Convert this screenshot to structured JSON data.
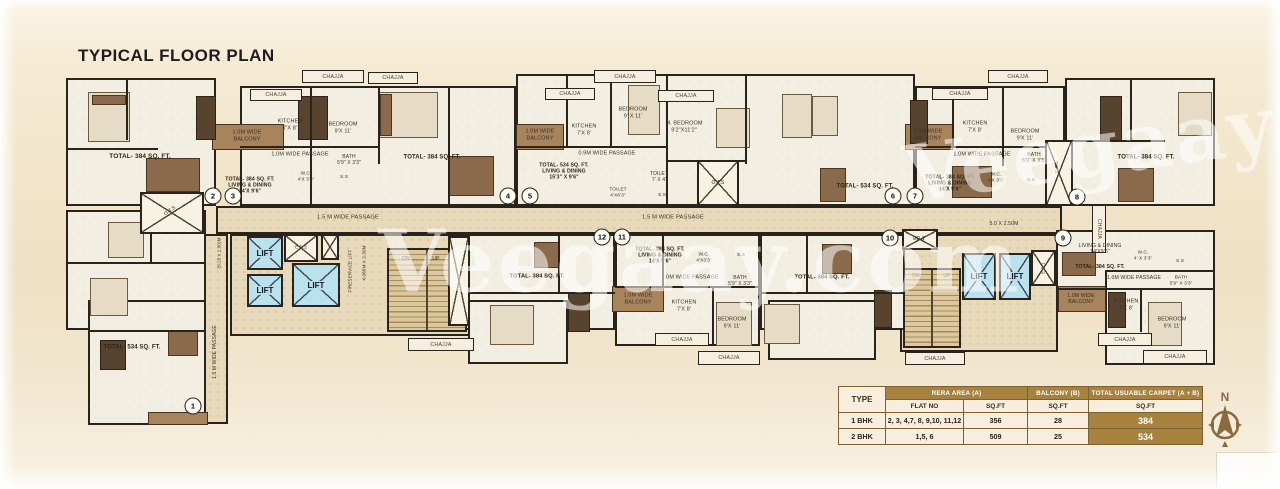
{
  "title": "TYPICAL FLOOR PLAN",
  "watermark": "Veegaay.com",
  "compass_label": "N",
  "colors": {
    "lift_blue": "#b9e1ee",
    "balcony_brown": "#a8845c",
    "wall": "#29231b",
    "table_brown": "#a7813e"
  },
  "table": {
    "col_type": "TYPE",
    "col_rera": "RERA AREA (A)",
    "col_balcony": "BALCONY (B)",
    "col_total": "TOTAL USUABLE CARPET (A + B)",
    "sub_flat_no": "FLAT NO",
    "sub_sqft": "SQ.FT",
    "rows": [
      {
        "type": "1 BHK",
        "flat_no": "2, 3, 4,7, 8, 9,10, 11,12",
        "rera_sqft": "356",
        "balcony_sqft": "28",
        "total_sqft": "384"
      },
      {
        "type": "2 BHK",
        "flat_no": "1,5, 6",
        "rera_sqft": "509",
        "balcony_sqft": "25",
        "total_sqft": "534"
      }
    ]
  },
  "plan": {
    "floors": [
      {
        "x": 66,
        "y": 78,
        "w": 150,
        "h": 128
      },
      {
        "x": 240,
        "y": 86,
        "w": 276,
        "h": 120
      },
      {
        "x": 516,
        "y": 74,
        "w": 399,
        "h": 132
      },
      {
        "x": 915,
        "y": 86,
        "w": 150,
        "h": 120
      },
      {
        "x": 1065,
        "y": 78,
        "w": 150,
        "h": 128
      },
      {
        "x": 455,
        "y": 234,
        "w": 160,
        "h": 96
      },
      {
        "x": 468,
        "y": 300,
        "w": 100,
        "h": 64
      },
      {
        "x": 615,
        "y": 234,
        "w": 145,
        "h": 112
      },
      {
        "x": 760,
        "y": 234,
        "w": 145,
        "h": 96
      },
      {
        "x": 768,
        "y": 300,
        "w": 108,
        "h": 60
      },
      {
        "x": 1056,
        "y": 230,
        "w": 159,
        "h": 82
      },
      {
        "x": 1105,
        "y": 270,
        "w": 110,
        "h": 95
      },
      {
        "x": 66,
        "y": 210,
        "w": 140,
        "h": 120
      },
      {
        "x": 88,
        "y": 300,
        "w": 118,
        "h": 125
      }
    ],
    "corridors": [
      {
        "x": 216,
        "y": 206,
        "w": 846,
        "h": 28
      },
      {
        "x": 204,
        "y": 234,
        "w": 24,
        "h": 190
      },
      {
        "x": 230,
        "y": 234,
        "w": 240,
        "h": 102
      },
      {
        "x": 900,
        "y": 234,
        "w": 158,
        "h": 118
      }
    ],
    "bands": [
      {
        "x": 212,
        "y": 124,
        "w": 72,
        "h": 26
      },
      {
        "x": 516,
        "y": 124,
        "w": 48,
        "h": 26
      },
      {
        "x": 905,
        "y": 124,
        "w": 48,
        "h": 26
      },
      {
        "x": 612,
        "y": 286,
        "w": 52,
        "h": 26
      },
      {
        "x": 1058,
        "y": 286,
        "w": 48,
        "h": 26
      },
      {
        "x": 148,
        "y": 412,
        "w": 60,
        "h": 13
      }
    ],
    "lifts": [
      {
        "x": 247,
        "y": 236,
        "w": 36,
        "h": 34,
        "label": "LIFT"
      },
      {
        "x": 247,
        "y": 274,
        "w": 36,
        "h": 33,
        "label": "LIFT"
      },
      {
        "x": 292,
        "y": 263,
        "w": 48,
        "h": 44,
        "label": "LIFT"
      },
      {
        "x": 962,
        "y": 253,
        "w": 34,
        "h": 47,
        "label": "LIFT"
      },
      {
        "x": 999,
        "y": 253,
        "w": 32,
        "h": 47,
        "label": "LIFT"
      }
    ],
    "ducts": [
      {
        "x": 284,
        "y": 234,
        "w": 34,
        "h": 28
      },
      {
        "x": 321,
        "y": 234,
        "w": 18,
        "h": 26
      },
      {
        "x": 448,
        "y": 236,
        "w": 22,
        "h": 90
      },
      {
        "x": 697,
        "y": 160,
        "w": 42,
        "h": 46
      },
      {
        "x": 1045,
        "y": 140,
        "w": 28,
        "h": 66
      },
      {
        "x": 902,
        "y": 229,
        "w": 36,
        "h": 21
      },
      {
        "x": 1031,
        "y": 250,
        "w": 25,
        "h": 36
      },
      {
        "x": 140,
        "y": 192,
        "w": 64,
        "h": 42
      }
    ],
    "stairs": [
      {
        "x": 387,
        "y": 248,
        "w": 80,
        "h": 84
      },
      {
        "x": 903,
        "y": 268,
        "w": 58,
        "h": 80
      }
    ],
    "chajjas": [
      {
        "x": 302,
        "y": 70,
        "w": 62,
        "h": 13,
        "label": "CHAJJA"
      },
      {
        "x": 250,
        "y": 89,
        "w": 52,
        "h": 12,
        "label": "CHAJJA"
      },
      {
        "x": 368,
        "y": 72,
        "w": 50,
        "h": 12,
        "label": "CHAJJA"
      },
      {
        "x": 545,
        "y": 88,
        "w": 50,
        "h": 12,
        "label": "CHAJJA"
      },
      {
        "x": 594,
        "y": 70,
        "w": 62,
        "h": 13,
        "label": "CHAJJA"
      },
      {
        "x": 658,
        "y": 90,
        "w": 56,
        "h": 12,
        "label": "CHAJJA"
      },
      {
        "x": 932,
        "y": 88,
        "w": 56,
        "h": 12,
        "label": "CHAJJA"
      },
      {
        "x": 988,
        "y": 70,
        "w": 60,
        "h": 13,
        "label": "CHAJJA"
      },
      {
        "x": 655,
        "y": 333,
        "w": 54,
        "h": 13,
        "label": "CHAJJA"
      },
      {
        "x": 698,
        "y": 351,
        "w": 62,
        "h": 14,
        "label": "CHAJJA"
      },
      {
        "x": 1098,
        "y": 333,
        "w": 54,
        "h": 13,
        "label": "CHAJJA"
      },
      {
        "x": 1143,
        "y": 350,
        "w": 64,
        "h": 14,
        "label": "CHAJJA"
      },
      {
        "x": 408,
        "y": 338,
        "w": 66,
        "h": 13,
        "label": "CHAJJA"
      },
      {
        "x": 905,
        "y": 352,
        "w": 60,
        "h": 13,
        "label": "CHAJJA"
      },
      {
        "x": 1092,
        "y": 205,
        "w": 14,
        "h": 48,
        "label": "CHAJJA",
        "v": 1
      }
    ],
    "flats": [
      {
        "n": "1",
        "x": 193,
        "y": 406
      },
      {
        "n": "2",
        "x": 213,
        "y": 196
      },
      {
        "n": "3",
        "x": 233,
        "y": 196
      },
      {
        "n": "4",
        "x": 508,
        "y": 196
      },
      {
        "n": "5",
        "x": 530,
        "y": 196
      },
      {
        "n": "6",
        "x": 893,
        "y": 196
      },
      {
        "n": "7",
        "x": 915,
        "y": 196
      },
      {
        "n": "8",
        "x": 1077,
        "y": 197
      },
      {
        "n": "9",
        "x": 1063,
        "y": 238
      },
      {
        "n": "10",
        "x": 890,
        "y": 238
      },
      {
        "n": "11",
        "x": 622,
        "y": 237
      },
      {
        "n": "12",
        "x": 602,
        "y": 237
      }
    ],
    "labels": [
      {
        "t": "TOTAL- 384 SQ. FT.",
        "x": 140,
        "y": 157,
        "s": 6.5,
        "b": 1
      },
      {
        "t": "1.0M WIDE\nBALCONY",
        "x": 247,
        "y": 136,
        "s": 5.5
      },
      {
        "t": "KITCHEN\n7'X 8'",
        "x": 290,
        "y": 125,
        "s": 5.5
      },
      {
        "t": "BEDROOM\n9'X 11'",
        "x": 343,
        "y": 128,
        "s": 5.5
      },
      {
        "t": "1.0M WIDE PASSAGE",
        "x": 300,
        "y": 155,
        "s": 5.5
      },
      {
        "t": "BATH\n5'9\" X 3'3\"",
        "x": 349,
        "y": 160,
        "s": 5
      },
      {
        "t": "W.C.\n4'X 3'3\"",
        "x": 306,
        "y": 177,
        "s": 4.8
      },
      {
        "t": "S.S",
        "x": 344,
        "y": 178,
        "s": 4.8
      },
      {
        "t": "TOTAL- 384 SQ. FT.\nLIVING & DINING\n14'X 9'6\"",
        "x": 250,
        "y": 186,
        "s": 5.2,
        "b": 1
      },
      {
        "t": "TOTAL- 384 SQ. FT.",
        "x": 432,
        "y": 158,
        "s": 6,
        "b": 1
      },
      {
        "t": "1.0M WIDE\nBALCONY",
        "x": 540,
        "y": 135,
        "s": 5.5
      },
      {
        "t": "KITCHEN\n7'X 8'",
        "x": 584,
        "y": 130,
        "s": 5.5
      },
      {
        "t": "BEDROOM\n9' X 11'",
        "x": 633,
        "y": 113,
        "s": 5.5
      },
      {
        "t": "M. BEDROOM\n9'2\"X11'2\"",
        "x": 684,
        "y": 127,
        "s": 5.5
      },
      {
        "t": "0.9M WIDE PASSAGE",
        "x": 607,
        "y": 154,
        "s": 5.5
      },
      {
        "t": "TOTAL- 534 SQ. FT.\nLIVING & DINING\n15'3\" X 9'6\"",
        "x": 564,
        "y": 172,
        "s": 5.2,
        "b": 1
      },
      {
        "t": "TOILET\n7' X 4'",
        "x": 659,
        "y": 177,
        "s": 5
      },
      {
        "t": "TOILET\n4'X6'3\"",
        "x": 618,
        "y": 193,
        "s": 4.8
      },
      {
        "t": "S.S",
        "x": 662,
        "y": 196,
        "s": 4.8
      },
      {
        "t": "O.T.S",
        "x": 718,
        "y": 183,
        "s": 5
      },
      {
        "t": "TOTAL- 534 SQ. FT.",
        "x": 865,
        "y": 187,
        "s": 6,
        "b": 1
      },
      {
        "t": "1.0M WIDE\nBALCONY",
        "x": 928,
        "y": 135,
        "s": 5.5
      },
      {
        "t": "KITCHEN\n7'X 8'",
        "x": 975,
        "y": 127,
        "s": 5.5
      },
      {
        "t": "BEDROOM\n9'X 11'",
        "x": 1025,
        "y": 135,
        "s": 5.5
      },
      {
        "t": "1.0M WIDE PASSAGE",
        "x": 982,
        "y": 155,
        "s": 5.5
      },
      {
        "t": "TOTAL- 384 SQ. FT.\nLIVING & DINING\n14'X 9'6\"",
        "x": 950,
        "y": 184,
        "s": 5.2,
        "b": 1
      },
      {
        "t": "BATH\n5'9\" X 3'3\"",
        "x": 1034,
        "y": 158,
        "s": 5
      },
      {
        "t": "W.C.\n4'X 3'3\"",
        "x": 996,
        "y": 178,
        "s": 4.8
      },
      {
        "t": "S.S",
        "x": 1031,
        "y": 181,
        "s": 4.8
      },
      {
        "t": "O.T.S",
        "x": 1058,
        "y": 167,
        "s": 4.8,
        "r": -90
      },
      {
        "t": "TOTAL- 384 SQ. FT.",
        "x": 1146,
        "y": 158,
        "s": 6,
        "b": 1
      },
      {
        "t": "1.5 M WIDE PASSAGE",
        "x": 348,
        "y": 218,
        "s": 5.8
      },
      {
        "t": "1.5 M WIDE PASSAGE",
        "x": 673,
        "y": 218,
        "s": 5.8
      },
      {
        "t": "5.0 X 2.50M",
        "x": 1004,
        "y": 224,
        "s": 5.2
      },
      {
        "t": "FIRESERVICE LIFT",
        "x": 350,
        "y": 271,
        "s": 4.6,
        "r": -90
      },
      {
        "t": "4.065M X 2.30M",
        "x": 364,
        "y": 263,
        "s": 4.6,
        "r": -90
      },
      {
        "t": "DN",
        "x": 406,
        "y": 259,
        "s": 5
      },
      {
        "t": "UP",
        "x": 436,
        "y": 259,
        "s": 5
      },
      {
        "t": "DN",
        "x": 916,
        "y": 276,
        "s": 5
      },
      {
        "t": "UP",
        "x": 947,
        "y": 276,
        "s": 5
      },
      {
        "t": "O.T.S",
        "x": 170,
        "y": 211,
        "s": 5,
        "r": -35
      },
      {
        "t": "(5.25 x 2.30)M",
        "x": 219,
        "y": 253,
        "s": 4.6,
        "r": -90
      },
      {
        "t": "1.5 M WIDE PASSAGE",
        "x": 215,
        "y": 352,
        "s": 5,
        "r": -90
      },
      {
        "t": "TOTAL- 534 SQ. FT.",
        "x": 132,
        "y": 348,
        "s": 6,
        "b": 1
      },
      {
        "t": "TOTAL- 384 SQ. FT.",
        "x": 537,
        "y": 277,
        "s": 5.8,
        "b": 1
      },
      {
        "t": "TOTAL- 384 SQ. FT.\nLIVING & DINING\n14'X 9'6\"",
        "x": 660,
        "y": 256,
        "s": 5.2,
        "b": 1
      },
      {
        "t": "W.C.\n4'X3'3\"",
        "x": 704,
        "y": 258,
        "s": 4.8
      },
      {
        "t": "S.S",
        "x": 741,
        "y": 256,
        "s": 4.8
      },
      {
        "t": "1.0M WIDE PASSAGE",
        "x": 690,
        "y": 278,
        "s": 5.5
      },
      {
        "t": "BATH\n5'9\" X 3'3\"",
        "x": 740,
        "y": 281,
        "s": 5
      },
      {
        "t": "1.0M WIDE\nBALCONY",
        "x": 638,
        "y": 299,
        "s": 5.5
      },
      {
        "t": "KITCHEN\n7'X 8'",
        "x": 684,
        "y": 306,
        "s": 5.5
      },
      {
        "t": "BEDROOM\n9'X 11'",
        "x": 732,
        "y": 323,
        "s": 5.5
      },
      {
        "t": "TOTAL- 384 SQ. FT.",
        "x": 822,
        "y": 278,
        "s": 5.8,
        "b": 1
      },
      {
        "t": "ED-1",
        "x": 919,
        "y": 239,
        "s": 5
      },
      {
        "t": "E.D.1",
        "x": 1043,
        "y": 268,
        "s": 4.5,
        "r": -90
      },
      {
        "t": "E.D.2",
        "x": 301,
        "y": 247,
        "s": 4.5
      },
      {
        "t": "LIVING & DINING\n14'X9'6\"",
        "x": 1100,
        "y": 249,
        "s": 5.2
      },
      {
        "t": "TOTAL- 384 SQ. FT.",
        "x": 1100,
        "y": 267,
        "s": 5.2,
        "b": 1
      },
      {
        "t": "W.C.\n4' X 3'3\"",
        "x": 1143,
        "y": 256,
        "s": 4.8
      },
      {
        "t": "S.S",
        "x": 1180,
        "y": 262,
        "s": 4.8
      },
      {
        "t": "1.0M WIDE PASSAGE",
        "x": 1134,
        "y": 278,
        "s": 5.2
      },
      {
        "t": "BATH\n5'9\" X 3'3\"",
        "x": 1181,
        "y": 281,
        "s": 4.8
      },
      {
        "t": "1.0M WIDE\nBALCONY",
        "x": 1081,
        "y": 299,
        "s": 5.2
      },
      {
        "t": "KITCHEN\n7'X 8'",
        "x": 1126,
        "y": 305,
        "s": 5.5
      },
      {
        "t": "BEDROOM\n9'X 11'",
        "x": 1172,
        "y": 323,
        "s": 5.5
      }
    ],
    "walls": [
      {
        "x": 126,
        "y": 78,
        "w": 2,
        "h": 62
      },
      {
        "x": 66,
        "y": 148,
        "w": 92,
        "h": 2
      },
      {
        "x": 310,
        "y": 86,
        "w": 2,
        "h": 120
      },
      {
        "x": 378,
        "y": 86,
        "w": 2,
        "h": 78
      },
      {
        "x": 448,
        "y": 86,
        "w": 2,
        "h": 120
      },
      {
        "x": 240,
        "y": 146,
        "w": 140,
        "h": 2
      },
      {
        "x": 566,
        "y": 74,
        "w": 2,
        "h": 74
      },
      {
        "x": 610,
        "y": 74,
        "w": 2,
        "h": 74
      },
      {
        "x": 516,
        "y": 146,
        "w": 150,
        "h": 2
      },
      {
        "x": 666,
        "y": 74,
        "w": 2,
        "h": 132
      },
      {
        "x": 745,
        "y": 74,
        "w": 2,
        "h": 90
      },
      {
        "x": 666,
        "y": 160,
        "w": 80,
        "h": 2
      },
      {
        "x": 952,
        "y": 86,
        "w": 2,
        "h": 62
      },
      {
        "x": 1002,
        "y": 86,
        "w": 2,
        "h": 80
      },
      {
        "x": 915,
        "y": 146,
        "w": 150,
        "h": 2
      },
      {
        "x": 1130,
        "y": 78,
        "w": 2,
        "h": 62
      },
      {
        "x": 1065,
        "y": 140,
        "w": 100,
        "h": 2
      },
      {
        "x": 558,
        "y": 234,
        "w": 2,
        "h": 60
      },
      {
        "x": 455,
        "y": 292,
        "w": 160,
        "h": 2
      },
      {
        "x": 662,
        "y": 234,
        "w": 2,
        "h": 54
      },
      {
        "x": 615,
        "y": 286,
        "w": 145,
        "h": 2
      },
      {
        "x": 712,
        "y": 288,
        "w": 2,
        "h": 58
      },
      {
        "x": 806,
        "y": 234,
        "w": 2,
        "h": 60
      },
      {
        "x": 760,
        "y": 292,
        "w": 145,
        "h": 2
      },
      {
        "x": 1056,
        "y": 288,
        "w": 159,
        "h": 2
      },
      {
        "x": 1140,
        "y": 290,
        "w": 2,
        "h": 42
      },
      {
        "x": 66,
        "y": 262,
        "w": 140,
        "h": 2
      },
      {
        "x": 88,
        "y": 330,
        "w": 118,
        "h": 2
      },
      {
        "x": 150,
        "y": 210,
        "w": 2,
        "h": 54
      }
    ],
    "decor": [
      [
        88,
        92,
        42,
        50,
        1
      ],
      [
        92,
        95,
        34,
        10,
        2
      ],
      [
        196,
        96,
        20,
        44,
        3
      ],
      [
        146,
        158,
        54,
        34,
        2
      ],
      [
        298,
        96,
        30,
        44,
        3
      ],
      [
        378,
        92,
        60,
        46,
        1
      ],
      [
        380,
        94,
        12,
        42,
        2
      ],
      [
        448,
        156,
        46,
        40,
        2
      ],
      [
        628,
        85,
        32,
        50,
        1
      ],
      [
        716,
        108,
        34,
        40,
        1
      ],
      [
        782,
        94,
        30,
        44,
        1
      ],
      [
        812,
        96,
        26,
        40,
        1
      ],
      [
        820,
        168,
        26,
        34,
        2
      ],
      [
        910,
        100,
        18,
        44,
        3
      ],
      [
        952,
        166,
        40,
        32,
        2
      ],
      [
        1100,
        96,
        22,
        46,
        3
      ],
      [
        1178,
        92,
        34,
        44,
        1
      ],
      [
        1118,
        168,
        36,
        34,
        2
      ],
      [
        108,
        222,
        36,
        36,
        1
      ],
      [
        90,
        278,
        38,
        38,
        1
      ],
      [
        168,
        330,
        30,
        26,
        2
      ],
      [
        100,
        340,
        26,
        30,
        3
      ],
      [
        534,
        242,
        26,
        26,
        2
      ],
      [
        490,
        305,
        44,
        40,
        1
      ],
      [
        568,
        292,
        22,
        40,
        3
      ],
      [
        716,
        302,
        36,
        44,
        1
      ],
      [
        822,
        244,
        30,
        30,
        2
      ],
      [
        764,
        304,
        36,
        40,
        1
      ],
      [
        874,
        290,
        18,
        38,
        3
      ],
      [
        1062,
        252,
        34,
        24,
        2
      ],
      [
        1148,
        302,
        34,
        44,
        1
      ],
      [
        1108,
        292,
        18,
        36,
        3
      ]
    ]
  }
}
